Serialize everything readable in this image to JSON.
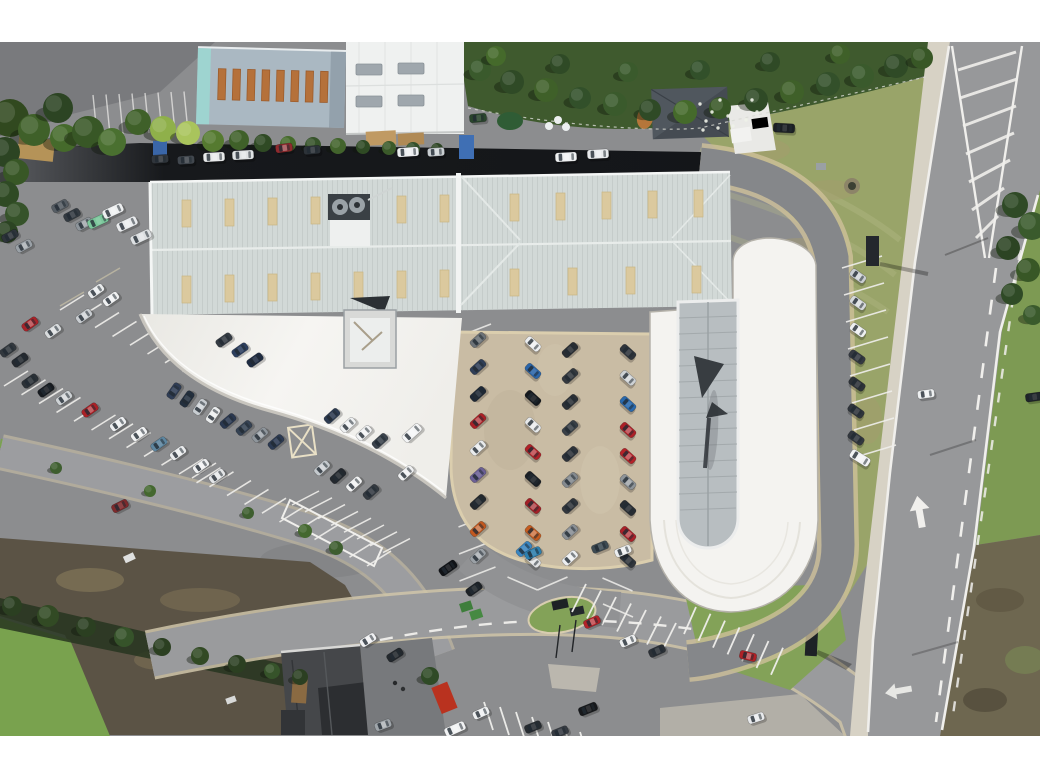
{
  "image": {
    "kind": "aerial-drone-photograph",
    "subject": "car dealership with showroom, workshop buildings, customer and stock parking, perimeter road and dual-carriageway",
    "letterbox": "white bars top and bottom"
  },
  "palette": {
    "bar": "#ffffff",
    "asphalt": "#8c8d8f",
    "road": "#97989a",
    "roadMinor": "#9a9b9d",
    "sidewalk": "#d7d2c5",
    "kerb": "#d0c6a9",
    "gravel": "#c9bca4",
    "lineWhite": "#f0efec",
    "canopy": "#f3f2ee",
    "showroom": "#f4f3f0",
    "glass": "#b8bec1",
    "glassFrame": "#8f959a",
    "roofMain": "#d2d9d7",
    "roofRidge": "#c3cac8",
    "skylightTan": "#dbc99e",
    "roofBlue": "#aab8c2",
    "roofBlueEdge": "#9ed4d0",
    "skylightOrange": "#b5713a",
    "roofWhiteBldg": "#eff1f0",
    "skylightGray": "#9fa7ad",
    "roofDark": "#454b52",
    "hedge": "#3f5a2e",
    "lawn": "#99a469",
    "grassBright": "#79a24e",
    "grassSide": "#7d9a53",
    "grassWedge": "#83a258",
    "scrub": "#6e6750",
    "brownLot": "#5b5345",
    "hedgeShadow": "#273520",
    "houseRoof": "#45474a",
    "arrowDark": "#383d41"
  },
  "vehicles": [
    [
      160,
      159,
      -4,
      "#30353b",
      "c"
    ],
    [
      186,
      160,
      -4,
      "#41474e",
      "c"
    ],
    [
      214,
      157,
      -3,
      "#e7e9ea",
      "v"
    ],
    [
      243,
      155,
      -3,
      "#dfe2e4",
      "v"
    ],
    [
      284,
      148,
      -8,
      "#8f2a2e",
      "c"
    ],
    [
      312,
      150,
      -5,
      "#2c3238",
      "c"
    ],
    [
      408,
      152,
      -4,
      "#eceef0",
      "v"
    ],
    [
      436,
      152,
      -4,
      "#c9ced2",
      "c"
    ],
    [
      566,
      157,
      -3,
      "#eff1f2",
      "v"
    ],
    [
      598,
      154,
      -3,
      "#e8eaec",
      "v"
    ],
    [
      784,
      128,
      3,
      "#1b1f24",
      "v"
    ],
    [
      10,
      236,
      -28,
      "#2e343a",
      "c"
    ],
    [
      24,
      246,
      -28,
      "#9aa1a7",
      "c"
    ],
    [
      60,
      206,
      -28,
      "#565d64",
      "c"
    ],
    [
      72,
      215,
      -28,
      "#333a41",
      "c"
    ],
    [
      84,
      224,
      -28,
      "#8e959b",
      "c"
    ],
    [
      98,
      221,
      -25,
      "#7bc79b",
      "v"
    ],
    [
      113,
      211,
      -25,
      "#edeff0",
      "v"
    ],
    [
      127,
      224,
      -25,
      "#e9ebed",
      "v"
    ],
    [
      141,
      237,
      -25,
      "#dde0e2",
      "v"
    ],
    [
      96,
      291,
      -35,
      "#e9ebec",
      "c"
    ],
    [
      111,
      299,
      -35,
      "#f0f1f2",
      "c"
    ],
    [
      84,
      316,
      -35,
      "#c9cdd1",
      "c"
    ],
    [
      53,
      331,
      -35,
      "#d8dbdd",
      "c"
    ],
    [
      30,
      324,
      -35,
      "#a82329",
      "c"
    ],
    [
      8,
      350,
      -35,
      "#32383e",
      "c"
    ],
    [
      20,
      360,
      -35,
      "#24292f",
      "c"
    ],
    [
      224,
      340,
      -35,
      "#343b43",
      "c"
    ],
    [
      240,
      350,
      -35,
      "#2c3e5e",
      "c"
    ],
    [
      255,
      360,
      -35,
      "#1f2c42",
      "c"
    ],
    [
      30,
      381,
      -35,
      "#2b3137",
      "c"
    ],
    [
      46,
      390,
      -35,
      "#171b20",
      "c"
    ],
    [
      64,
      398,
      -35,
      "#ced2d5",
      "c"
    ],
    [
      90,
      410,
      -35,
      "#ab2026",
      "c"
    ],
    [
      118,
      424,
      -35,
      "#eceef0",
      "c"
    ],
    [
      139,
      434,
      -35,
      "#f1f2f3",
      "c"
    ],
    [
      159,
      444,
      -35,
      "#5e86a0",
      "c"
    ],
    [
      178,
      453,
      -35,
      "#e9ebed",
      "c"
    ],
    [
      201,
      466,
      -35,
      "#eff0f1",
      "c"
    ],
    [
      217,
      476,
      -35,
      "#e3e5e7",
      "c"
    ],
    [
      174,
      391,
      -55,
      "#2f3d55",
      "c"
    ],
    [
      187,
      399,
      -55,
      "#232f3e",
      "c"
    ],
    [
      200,
      407,
      -55,
      "#c8cdd1",
      "c"
    ],
    [
      213,
      415,
      -55,
      "#eaeced",
      "c"
    ],
    [
      228,
      421,
      -40,
      "#2a3850",
      "c"
    ],
    [
      244,
      428,
      -40,
      "#354253",
      "c"
    ],
    [
      260,
      435,
      -40,
      "#8f969c",
      "c"
    ],
    [
      276,
      442,
      -40,
      "#2c3a52",
      "c"
    ],
    [
      332,
      416,
      -42,
      "#2d3b51",
      "c"
    ],
    [
      348,
      425,
      -42,
      "#eef0f1",
      "c"
    ],
    [
      364,
      433,
      -42,
      "#f2f3f4",
      "c"
    ],
    [
      380,
      441,
      -42,
      "#3b434c",
      "c"
    ],
    [
      412,
      433,
      -42,
      "#f4f5f6",
      "v"
    ],
    [
      322,
      468,
      -42,
      "#c4c9cd",
      "c"
    ],
    [
      338,
      476,
      -42,
      "#23282e",
      "c"
    ],
    [
      354,
      484,
      -42,
      "#f0f1f2",
      "c"
    ],
    [
      371,
      492,
      -42,
      "#343a41",
      "c"
    ],
    [
      406,
      473,
      -42,
      "#eff0f1",
      "c"
    ],
    [
      478,
      340,
      -42,
      "#6c7277",
      "c"
    ],
    [
      478,
      367,
      -42,
      "#2f3e57",
      "c"
    ],
    [
      478,
      394,
      -42,
      "#1e2835",
      "c"
    ],
    [
      478,
      421,
      -42,
      "#aa2127",
      "c"
    ],
    [
      478,
      448,
      -42,
      "#e9ebec",
      "c"
    ],
    [
      478,
      475,
      -42,
      "#6c6096",
      "c"
    ],
    [
      478,
      502,
      -42,
      "#23282d",
      "c"
    ],
    [
      478,
      529,
      -42,
      "#c2581f",
      "c"
    ],
    [
      478,
      556,
      -42,
      "#9ba1a6",
      "c"
    ],
    [
      533,
      344,
      42,
      "#eceef0",
      "c"
    ],
    [
      533,
      371,
      42,
      "#2a65a9",
      "c"
    ],
    [
      533,
      398,
      42,
      "#15191e",
      "c"
    ],
    [
      533,
      425,
      42,
      "#e7e9ea",
      "c"
    ],
    [
      533,
      452,
      42,
      "#b02127",
      "c"
    ],
    [
      533,
      479,
      42,
      "#1b2026",
      "c"
    ],
    [
      533,
      506,
      42,
      "#a32027",
      "c"
    ],
    [
      533,
      533,
      42,
      "#c45b1f",
      "c"
    ],
    [
      533,
      560,
      42,
      "#e0e2e4",
      "c"
    ],
    [
      570,
      350,
      -42,
      "#282d33",
      "c"
    ],
    [
      570,
      376,
      -42,
      "#34393f",
      "c"
    ],
    [
      570,
      402,
      -42,
      "#2b3036",
      "c"
    ],
    [
      570,
      428,
      -42,
      "#394047",
      "c"
    ],
    [
      570,
      454,
      -42,
      "#2e333a",
      "c"
    ],
    [
      570,
      480,
      -42,
      "#848a8f",
      "c"
    ],
    [
      570,
      506,
      -42,
      "#32373d",
      "c"
    ],
    [
      570,
      532,
      -42,
      "#898f94",
      "c"
    ],
    [
      570,
      558,
      -42,
      "#eceef0",
      "c"
    ],
    [
      628,
      352,
      42,
      "#2f343b",
      "c"
    ],
    [
      628,
      378,
      42,
      "#cdd1d4",
      "c"
    ],
    [
      628,
      404,
      42,
      "#2969ad",
      "c"
    ],
    [
      628,
      430,
      42,
      "#ac2027",
      "c"
    ],
    [
      628,
      456,
      42,
      "#b52229",
      "c"
    ],
    [
      628,
      482,
      42,
      "#8e9499",
      "c"
    ],
    [
      628,
      508,
      42,
      "#282d33",
      "c"
    ],
    [
      628,
      534,
      42,
      "#aa2129",
      "c"
    ],
    [
      628,
      560,
      42,
      "#31363c",
      "c"
    ],
    [
      524,
      549,
      -42,
      "#3a86c1",
      "c"
    ],
    [
      533,
      553,
      -25,
      "#2d7fae",
      "c"
    ],
    [
      600,
      547,
      -22,
      "#3d4a52",
      "c"
    ],
    [
      623,
      551,
      -22,
      "#eceeef",
      "c"
    ],
    [
      858,
      276,
      35,
      "#caced2",
      "c"
    ],
    [
      858,
      303,
      35,
      "#d5d8da",
      "c"
    ],
    [
      858,
      330,
      35,
      "#eef0f1",
      "c"
    ],
    [
      857,
      357,
      35,
      "#343941",
      "c"
    ],
    [
      857,
      384,
      35,
      "#2d3238",
      "c"
    ],
    [
      856,
      411,
      35,
      "#2f343b",
      "c"
    ],
    [
      856,
      438,
      35,
      "#32373e",
      "c"
    ],
    [
      860,
      458,
      32,
      "#f2f3f4",
      "v"
    ],
    [
      592,
      622,
      -24,
      "#b42228",
      "c"
    ],
    [
      628,
      641,
      -24,
      "#eceeef",
      "c"
    ],
    [
      657,
      651,
      -24,
      "#2b3036",
      "c"
    ],
    [
      748,
      656,
      14,
      "#b02127",
      "c"
    ],
    [
      448,
      568,
      -35,
      "#101317",
      "s"
    ],
    [
      474,
      589,
      -35,
      "#1c2126",
      "c"
    ],
    [
      368,
      640,
      -32,
      "#eff0f2",
      "c"
    ],
    [
      395,
      655,
      -32,
      "#23282d",
      "c"
    ],
    [
      588,
      709,
      -22,
      "#17191c",
      "s"
    ],
    [
      481,
      713,
      -24,
      "#eef0f1",
      "c"
    ],
    [
      455,
      729,
      -24,
      "#f1f2f3",
      "v"
    ],
    [
      383,
      725,
      -20,
      "#9fa5aa",
      "c"
    ],
    [
      533,
      727,
      -22,
      "#272c31",
      "c"
    ],
    [
      560,
      732,
      -22,
      "#363b42",
      "c"
    ],
    [
      756,
      718,
      -18,
      "#e8eaec",
      "c"
    ],
    [
      120,
      506,
      -27,
      "#7e2a2c",
      "c"
    ],
    [
      926,
      394,
      -8,
      "#eef0f1",
      "c"
    ],
    [
      1034,
      397,
      -8,
      "#1f2429",
      "c"
    ],
    [
      478,
      118,
      -5,
      "#29452c",
      "c"
    ]
  ],
  "trees": [
    [
      10,
      118,
      19,
      "#31491f"
    ],
    [
      34,
      130,
      16,
      "#3f6029"
    ],
    [
      58,
      108,
      15,
      "#2c4423"
    ],
    [
      64,
      138,
      14,
      "#456a2b"
    ],
    [
      88,
      132,
      16,
      "#385726"
    ],
    [
      112,
      142,
      14,
      "#4a7030"
    ],
    [
      138,
      122,
      13,
      "#3f6029"
    ],
    [
      163,
      129,
      13,
      "#8fb04a"
    ],
    [
      188,
      133,
      12,
      "#a9c45c"
    ],
    [
      213,
      141,
      11,
      "#557a30"
    ],
    [
      239,
      140,
      10,
      "#3f6029"
    ],
    [
      263,
      143,
      9,
      "#2f4a24"
    ],
    [
      288,
      144,
      8,
      "#456a2b"
    ],
    [
      313,
      145,
      8,
      "#36532a"
    ],
    [
      338,
      146,
      8,
      "#42632c"
    ],
    [
      363,
      147,
      7,
      "#2f4a24"
    ],
    [
      389,
      148,
      7,
      "#3b5a2a"
    ],
    [
      413,
      149,
      7,
      "#33502a"
    ],
    [
      437,
      149,
      6,
      "#2c4423"
    ],
    [
      5,
      152,
      15,
      "#2c4423"
    ],
    [
      16,
      172,
      13,
      "#385726"
    ],
    [
      6,
      194,
      13,
      "#2f4a24"
    ],
    [
      17,
      214,
      12,
      "#36532a"
    ],
    [
      7,
      232,
      11,
      "#2c4423"
    ],
    [
      1015,
      205,
      13,
      "#2f4a26"
    ],
    [
      1032,
      226,
      14,
      "#3a5a2c"
    ],
    [
      1008,
      248,
      12,
      "#2c4423"
    ],
    [
      1028,
      270,
      12,
      "#385726"
    ],
    [
      1012,
      294,
      11,
      "#2f4a26"
    ],
    [
      1033,
      315,
      10,
      "#3a5a2c"
    ],
    [
      480,
      70,
      11,
      "#3a5a2c"
    ],
    [
      512,
      82,
      12,
      "#2f4a26"
    ],
    [
      546,
      90,
      12,
      "#3f6029"
    ],
    [
      580,
      98,
      11,
      "#32502a"
    ],
    [
      615,
      104,
      12,
      "#3a5a2c"
    ],
    [
      650,
      110,
      11,
      "#2f4a26"
    ],
    [
      685,
      112,
      12,
      "#456a2b"
    ],
    [
      720,
      108,
      11,
      "#385726"
    ],
    [
      756,
      100,
      12,
      "#2f4a26"
    ],
    [
      792,
      92,
      12,
      "#3f6029"
    ],
    [
      828,
      84,
      12,
      "#33502a"
    ],
    [
      862,
      76,
      12,
      "#3a5a2c"
    ],
    [
      896,
      66,
      12,
      "#2f4a26"
    ],
    [
      922,
      58,
      11,
      "#385726"
    ],
    [
      496,
      56,
      10,
      "#456a2b"
    ],
    [
      560,
      64,
      10,
      "#2f4a26"
    ],
    [
      628,
      72,
      10,
      "#3a5a2c"
    ],
    [
      700,
      70,
      10,
      "#32502a"
    ],
    [
      770,
      62,
      10,
      "#2f4a26"
    ],
    [
      840,
      54,
      10,
      "#3f6029"
    ],
    [
      12,
      606,
      10,
      "#2b3f21"
    ],
    [
      48,
      616,
      11,
      "#324a24"
    ],
    [
      86,
      627,
      10,
      "#2b3f21"
    ],
    [
      124,
      637,
      10,
      "#36532a"
    ],
    [
      162,
      647,
      9,
      "#2b3f21"
    ],
    [
      200,
      656,
      9,
      "#324a24"
    ],
    [
      237,
      664,
      9,
      "#2b3f21"
    ],
    [
      272,
      671,
      8,
      "#36532a"
    ],
    [
      300,
      677,
      8,
      "#2b3f21"
    ],
    [
      56,
      468,
      6,
      "#3e5e2f"
    ],
    [
      150,
      491,
      6,
      "#44682f"
    ],
    [
      248,
      513,
      6,
      "#3e5e2f"
    ],
    [
      305,
      531,
      7,
      "#44682f"
    ],
    [
      336,
      548,
      7,
      "#3e5e2f"
    ],
    [
      430,
      676,
      9,
      "#2f4a26"
    ]
  ],
  "flowers": [
    [
      700,
      104
    ],
    [
      712,
      112
    ],
    [
      706,
      121
    ],
    [
      720,
      100
    ],
    [
      728,
      116
    ],
    [
      738,
      108
    ],
    [
      746,
      120
    ],
    [
      718,
      128
    ],
    [
      752,
      100
    ],
    [
      733,
      126
    ],
    [
      703,
      130
    ],
    [
      757,
      112
    ]
  ],
  "bay_rows": [
    {
      "x": 93,
      "y": 95,
      "sx": 13,
      "sy": -0.5,
      "n": 8,
      "dx": 4,
      "dy": 40,
      "w": 1.4,
      "o": 0.7
    },
    {
      "x": 60,
      "y": 310,
      "sx": 17.5,
      "sy": 8.8,
      "n": 10,
      "dx": 24,
      "dy": -15,
      "w": 1.6,
      "o": 0.9
    },
    {
      "x": 4,
      "y": 386,
      "sx": 17.5,
      "sy": 8.8,
      "n": 12,
      "dx": 24,
      "dy": -15,
      "w": 1.6,
      "o": 0.9
    },
    {
      "x": 192,
      "y": 478,
      "sx": 17.5,
      "sy": 8.8,
      "n": 11,
      "dx": 24,
      "dy": -15,
      "w": 1.6,
      "o": 0.9
    },
    {
      "x": 842,
      "y": 268,
      "sx": 2,
      "sy": 27,
      "n": 8,
      "dx": 40,
      "dy": -12,
      "w": 1.6,
      "o": 0.9
    },
    {
      "x": 455,
      "y": 338,
      "sx": 0.5,
      "sy": 27,
      "n": 10,
      "dx": 36,
      "dy": -14,
      "w": 1.6,
      "o": 0.85
    },
    {
      "x": 503,
      "y": 334,
      "sx": 0.5,
      "sy": 27,
      "n": 10,
      "dx": 30,
      "dy": 13,
      "w": 1.6,
      "o": 0.85
    },
    {
      "x": 533,
      "y": 347,
      "sx": 0.5,
      "sy": 27,
      "n": 10,
      "dx": 30,
      "dy": -13,
      "w": 1.6,
      "o": 0.85
    },
    {
      "x": 598,
      "y": 344,
      "sx": 0.5,
      "sy": 26,
      "n": 11,
      "dx": 30,
      "dy": 13,
      "w": 1.6,
      "o": 0.85
    },
    {
      "x": 572,
      "y": 612,
      "sx": 15,
      "sy": 6.5,
      "n": 7,
      "dx": 14,
      "dy": -28,
      "w": 1.8,
      "o": 0.95
    },
    {
      "x": 684,
      "y": 634,
      "sx": 14.5,
      "sy": 6.8,
      "n": 7,
      "dx": 12,
      "dy": -27,
      "w": 1.8,
      "o": 0.95
    },
    {
      "x": 484,
      "y": 702,
      "sx": 16,
      "sy": 5,
      "n": 8,
      "dx": 9,
      "dy": 28,
      "w": 1.8,
      "o": 0.95
    },
    {
      "x": 292,
      "y": 505,
      "sx": 13,
      "sy": 6.8,
      "n": 8,
      "dx": 27,
      "dy": -14,
      "w": 1.5,
      "o": 0.9
    }
  ],
  "hatch": [
    [
      958,
      70,
      1016,
      52
    ],
    [
      960,
      98,
      1017,
      79
    ],
    [
      963,
      126,
      1016,
      106
    ],
    [
      966,
      154,
      1014,
      133
    ],
    [
      969,
      182,
      1010,
      160
    ],
    [
      972,
      210,
      1004,
      188
    ],
    [
      976,
      238,
      998,
      216
    ]
  ]
}
